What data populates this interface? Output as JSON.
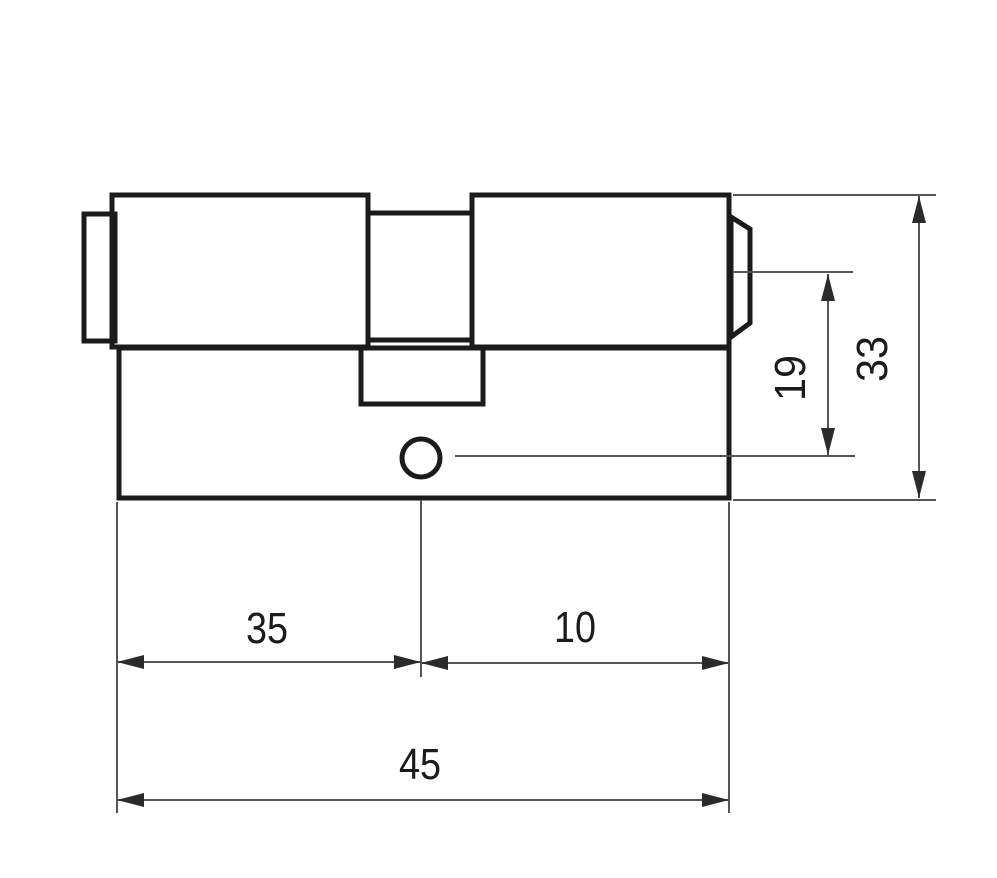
{
  "figure": {
    "kind": "technical-dimension-drawing",
    "subject": "lock-cylinder-side-view",
    "colors": {
      "background": "#ffffff",
      "outline": "#1b1b1b",
      "dimension_lines": "#555555",
      "arrowheads": "#2b2b2b",
      "text": "#1b1b1b"
    }
  },
  "dimensions": {
    "left_section_length": "35",
    "right_section_length": "10",
    "overall_length": "45",
    "cam_to_hole_height": "19",
    "overall_height": "33"
  }
}
